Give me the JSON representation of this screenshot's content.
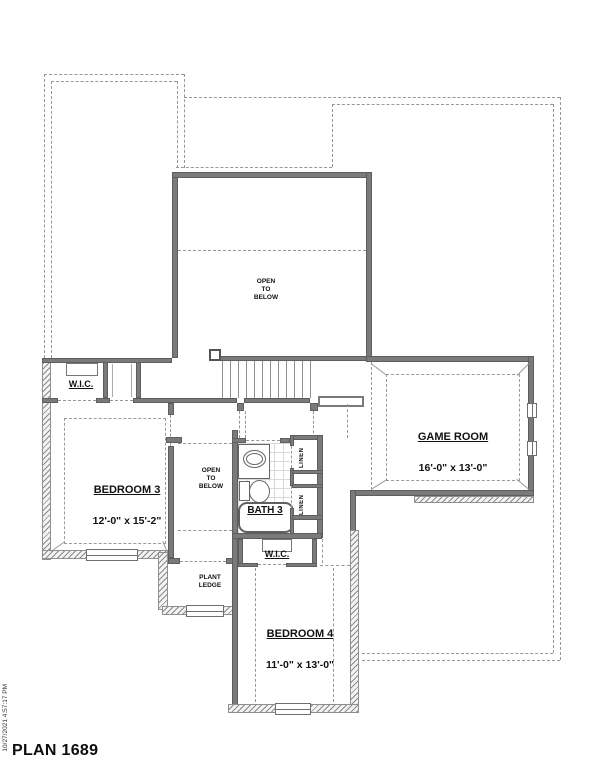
{
  "meta": {
    "plan_title": "PLAN 1689",
    "timestamp": "10/27/2021 4:57:17 PM"
  },
  "rooms": {
    "bedroom3": {
      "name": "BEDROOM 3",
      "dims": "12'-0\" x 15'-2\""
    },
    "bedroom4": {
      "name": "BEDROOM 4",
      "dims": "11'-0\" x 13'-0\""
    },
    "game_room": {
      "name": "GAME ROOM",
      "dims": "16'-0\" x 13'-0\""
    }
  },
  "labels": {
    "open_to_below_upper": "OPEN\nTO\nBELOW",
    "open_to_below_hall": "OPEN\nTO\nBELOW",
    "wic_bedroom3": "W.I.C.",
    "wic_bedroom4": "W.I.C.",
    "linen_upper": "LINEN",
    "linen_lower": "LINEN",
    "plant_ledge": "PLANT\nLEDGE",
    "bath3": "BATH 3"
  },
  "colors": {
    "wall": "#7a7a7a",
    "dashed_line": "#999999",
    "text": "#111111",
    "background": "#ffffff"
  }
}
